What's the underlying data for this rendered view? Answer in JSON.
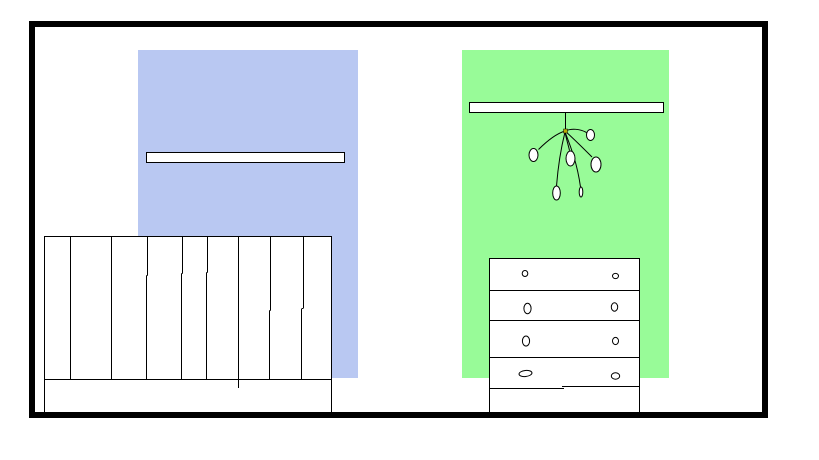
{
  "scene": {
    "description": "Hand-drawn room interior: black outer frame, a light-blue wall panel and a light-green wall panel, a white shelf on each panel, a hanging mobile with six pods under the right shelf, a slatted crib on the left and a four-drawer dresser on the right",
    "items": [
      {
        "name": "room-frame",
        "shape": "rectangle-border"
      },
      {
        "name": "wall-panel-left",
        "color_key": "wall_left"
      },
      {
        "name": "wall-panel-right",
        "color_key": "wall_right"
      },
      {
        "name": "shelf-left",
        "fill": "white"
      },
      {
        "name": "shelf-right",
        "fill": "white"
      },
      {
        "name": "hanging-mobile",
        "pod_count": 6,
        "has_center_knot": true
      },
      {
        "name": "crib",
        "slat_line_count": 8,
        "has_base_board": true
      },
      {
        "name": "dresser",
        "drawer_count": 4,
        "knobs_per_drawer": 2
      }
    ]
  },
  "colors": {
    "canvas_bg": "#ffffff",
    "outline": "#000000",
    "surface": "#ffffff",
    "wall_left": "#b9c8f2",
    "wall_right": "#98fb98",
    "mobile_knot": "#b8a800"
  }
}
